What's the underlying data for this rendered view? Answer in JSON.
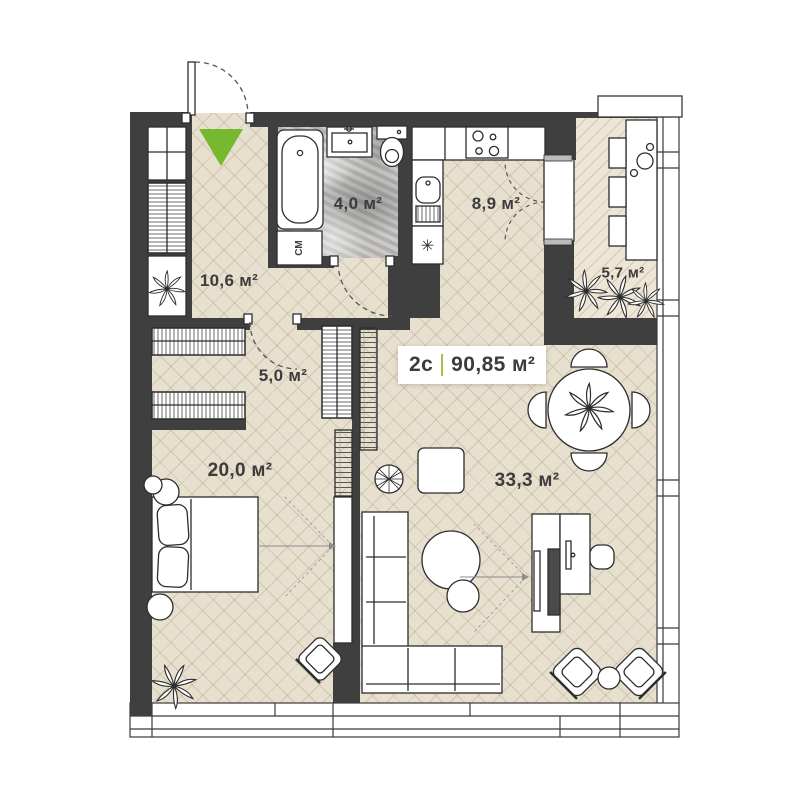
{
  "plan": {
    "title": {
      "type": "2с",
      "area": "90,85 м²"
    },
    "rooms": {
      "hallway": "10,6 м²",
      "bathroom": "4,0 м²",
      "kitchen": "8,9 м²",
      "balcony": "5,7 м²",
      "closet": "5,0 м²",
      "bedroom": "20,0 м²",
      "living": "33,3 м²"
    },
    "appliances": {
      "washing_machine": "СМ",
      "fridge": "✳"
    },
    "colors": {
      "wall": "#3f3f3f",
      "floor": "#e8e0cf",
      "balcony": "#ede6d7",
      "bath": "#c0bfbd",
      "green": "#76b82e",
      "olive": "#b6ba45",
      "outline": "#2d2d2d",
      "label": "#3c3c3c"
    }
  }
}
